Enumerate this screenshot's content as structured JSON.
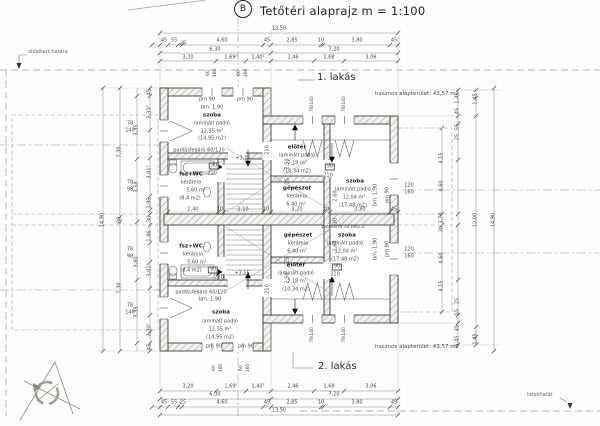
{
  "title": {
    "section_marker": "B",
    "text": "Tetőtéri alaprajz  m = 1:100"
  },
  "units": {
    "flat1": {
      "label": "1. lakás",
      "area": "hasznos alapterület: 43,57 m2"
    },
    "flat2": {
      "label": "2. lakás",
      "area": "hasznos alapterület: 43,57 m2"
    }
  },
  "boundaries": {
    "side_garden": "oldalkert határa",
    "plot": "telekhatár"
  },
  "plan_labels": {
    "dimensions": [
      {
        "t": "13,50",
        "x": 279,
        "y": 29
      },
      {
        "t": "45",
        "x": 164,
        "y": 41
      },
      {
        "t": "55",
        "x": 174,
        "y": 41
      },
      {
        "t": "25",
        "x": 183,
        "y": 44
      },
      {
        "t": "4,60",
        "x": 222,
        "y": 41
      },
      {
        "t": "45",
        "x": 267,
        "y": 41
      },
      {
        "t": "2,85",
        "x": 292,
        "y": 41
      },
      {
        "t": "10",
        "x": 321,
        "y": 41
      },
      {
        "t": "3,80",
        "x": 357,
        "y": 41
      },
      {
        "t": "45",
        "x": 394,
        "y": 41
      },
      {
        "t": "6,30",
        "x": 215,
        "y": 50
      },
      {
        "t": "7,20",
        "x": 334,
        "y": 50
      },
      {
        "t": "3,20",
        "x": 188,
        "y": 58
      },
      {
        "t": "1,69⁵",
        "x": 231,
        "y": 58
      },
      {
        "t": "1,40²",
        "x": 258,
        "y": 58
      },
      {
        "t": "2,46",
        "x": 293,
        "y": 58
      },
      {
        "t": "1,68",
        "x": 329,
        "y": 58
      },
      {
        "t": "3,06",
        "x": 371,
        "y": 58
      },
      {
        "t": "3,20",
        "x": 188,
        "y": 387
      },
      {
        "t": "1,69⁵",
        "x": 231,
        "y": 387
      },
      {
        "t": "1,40²",
        "x": 258,
        "y": 387
      },
      {
        "t": "2,46",
        "x": 293,
        "y": 387
      },
      {
        "t": "1,68",
        "x": 329,
        "y": 387
      },
      {
        "t": "3,06",
        "x": 371,
        "y": 387
      },
      {
        "t": "6,30",
        "x": 215,
        "y": 395
      },
      {
        "t": "7,20",
        "x": 334,
        "y": 395
      },
      {
        "t": "45",
        "x": 164,
        "y": 403
      },
      {
        "t": "55",
        "x": 174,
        "y": 403
      },
      {
        "t": "25",
        "x": 183,
        "y": 403
      },
      {
        "t": "4,60",
        "x": 222,
        "y": 403
      },
      {
        "t": "45",
        "x": 267,
        "y": 403
      },
      {
        "t": "2,85",
        "x": 292,
        "y": 403
      },
      {
        "t": "10",
        "x": 321,
        "y": 403
      },
      {
        "t": "3,80",
        "x": 357,
        "y": 403
      },
      {
        "t": "45",
        "x": 394,
        "y": 403
      },
      {
        "t": "13,50",
        "x": 279,
        "y": 411
      },
      {
        "t": "14,90",
        "x": 103,
        "y": 220,
        "r": 1
      },
      {
        "t": "7,30",
        "x": 120,
        "y": 152,
        "r": 1
      },
      {
        "t": "30",
        "x": 120,
        "y": 220,
        "r": 1
      },
      {
        "t": "7,30",
        "x": 120,
        "y": 288,
        "r": 1
      },
      {
        "t": "3,35",
        "x": 137,
        "y": 130,
        "r": 1
      },
      {
        "t": "3,58",
        "x": 137,
        "y": 187,
        "r": 1
      },
      {
        "t": "3,80",
        "x": 137,
        "y": 262,
        "r": 1
      },
      {
        "t": "3,35",
        "x": 137,
        "y": 312,
        "r": 1
      },
      {
        "t": "45",
        "x": 150,
        "y": 92,
        "r": 1
      },
      {
        "t": "2,33⁵",
        "x": 150,
        "y": 112,
        "r": 1
      },
      {
        "t": "3,01⁵",
        "x": 150,
        "y": 172,
        "r": 1
      },
      {
        "t": "1,95",
        "x": 150,
        "y": 203,
        "r": 1
      },
      {
        "t": "30",
        "x": 150,
        "y": 219,
        "r": 1
      },
      {
        "t": "1,86",
        "x": 150,
        "y": 236,
        "r": 1
      },
      {
        "t": "3,01⁵",
        "x": 150,
        "y": 270,
        "r": 1
      },
      {
        "t": "2,30⁵",
        "x": 150,
        "y": 330,
        "r": 1
      },
      {
        "t": "45",
        "x": 150,
        "y": 347,
        "r": 1
      },
      {
        "t": "4,15",
        "x": 442,
        "y": 158,
        "r": 1
      },
      {
        "t": "4,60",
        "x": 442,
        "y": 186,
        "r": 1
      },
      {
        "t": "3,70",
        "x": 442,
        "y": 218,
        "r": 1
      },
      {
        "t": "30",
        "x": 442,
        "y": 229,
        "r": 1
      },
      {
        "t": "4,60",
        "x": 442,
        "y": 258,
        "r": 1
      },
      {
        "t": "4,15",
        "x": 442,
        "y": 286,
        "r": 1
      },
      {
        "t": "1,45",
        "x": 458,
        "y": 98,
        "r": 1
      },
      {
        "t": "45",
        "x": 458,
        "y": 111,
        "r": 1
      },
      {
        "t": "55",
        "x": 458,
        "y": 127,
        "r": 1
      },
      {
        "t": "25",
        "x": 458,
        "y": 137,
        "r": 1
      },
      {
        "t": "25",
        "x": 458,
        "y": 301,
        "r": 1
      },
      {
        "t": "55",
        "x": 458,
        "y": 312,
        "r": 1
      },
      {
        "t": "45",
        "x": 458,
        "y": 328,
        "r": 1
      },
      {
        "t": "1,45",
        "x": 458,
        "y": 341,
        "r": 1
      },
      {
        "t": "1,45",
        "x": 476,
        "y": 99,
        "r": 1
      },
      {
        "t": "12,00",
        "x": 476,
        "y": 220,
        "r": 1
      },
      {
        "t": "1,45",
        "x": 476,
        "y": 339,
        "r": 1
      },
      {
        "t": "14,90",
        "x": 494,
        "y": 220,
        "r": 1
      },
      {
        "t": "2,40",
        "x": 193,
        "y": 210
      },
      {
        "t": "10",
        "x": 220,
        "y": 210
      },
      {
        "t": "2,10",
        "x": 243,
        "y": 210
      },
      {
        "t": "10",
        "x": 266,
        "y": 210
      },
      {
        "t": "3,20",
        "x": 297,
        "y": 210
      },
      {
        "t": "10",
        "x": 326,
        "y": 210
      },
      {
        "t": "3,80",
        "x": 360,
        "y": 210
      },
      {
        "t": "45",
        "x": 394,
        "y": 210
      },
      {
        "t": "2,50",
        "x": 288,
        "y": 164,
        "r": 1
      },
      {
        "t": "25",
        "x": 288,
        "y": 181,
        "r": 1
      },
      {
        "t": "2,60",
        "x": 336,
        "y": 196,
        "r": 1
      },
      {
        "t": "30",
        "x": 336,
        "y": 221,
        "r": 1
      },
      {
        "t": "2,60",
        "x": 336,
        "y": 246,
        "r": 1
      },
      {
        "t": "25",
        "x": 288,
        "y": 260,
        "r": 1
      },
      {
        "t": "2,50",
        "x": 288,
        "y": 278,
        "r": 1
      },
      {
        "t": "60",
        "x": 209,
        "y": 73,
        "r": 1,
        "sm": 1
      },
      {
        "t": "160",
        "x": 216,
        "y": 73,
        "r": 1,
        "sm": 1
      },
      {
        "t": "60",
        "x": 240,
        "y": 73,
        "r": 1,
        "sm": 1
      },
      {
        "t": "160",
        "x": 247,
        "y": 73,
        "r": 1,
        "sm": 1
      },
      {
        "t": "60",
        "x": 215,
        "y": 368,
        "r": 1,
        "sm": 1
      },
      {
        "t": "160",
        "x": 222,
        "y": 368,
        "r": 1,
        "sm": 1
      },
      {
        "t": "60",
        "x": 242,
        "y": 368,
        "r": 1,
        "sm": 1
      },
      {
        "t": "160",
        "x": 249,
        "y": 368,
        "r": 1,
        "sm": 1
      }
    ],
    "rooms": [
      {
        "t": "pm 90",
        "x": 207,
        "y": 100
      },
      {
        "t": "pm 90",
        "x": 245,
        "y": 100
      },
      {
        "t": "bm. 1,90",
        "x": 212,
        "y": 108
      },
      {
        "t": "szoba",
        "x": 212,
        "y": 116,
        "b": 1
      },
      {
        "t": "laminált padló",
        "x": 212,
        "y": 124
      },
      {
        "t": "12,35 m²",
        "x": 212,
        "y": 132
      },
      {
        "t": "(14,95 m2)",
        "x": 212,
        "y": 139
      },
      {
        "t": "padlásfeljáró 60/120",
        "x": 199,
        "y": 151
      },
      {
        "t": "fsz+WC",
        "x": 191,
        "y": 175,
        "b": 1
      },
      {
        "t": "kerámia",
        "x": 191,
        "y": 183
      },
      {
        "t": "5,60 m²",
        "x": 196,
        "y": 191
      },
      {
        "t": "(8,4 m2)",
        "x": 190,
        "y": 199
      },
      {
        "t": "előtér",
        "x": 297,
        "y": 148,
        "b": 1
      },
      {
        "t": "laminált padló",
        "x": 297,
        "y": 156
      },
      {
        "t": "7,18 m²",
        "x": 297,
        "y": 164
      },
      {
        "t": "(10,34 m2)",
        "x": 297,
        "y": 172
      },
      {
        "t": "gépészet",
        "x": 297,
        "y": 189,
        "b": 1
      },
      {
        "t": "kerámia",
        "x": 297,
        "y": 197
      },
      {
        "t": "6,40 m²",
        "x": 296,
        "y": 205
      },
      {
        "t": "szoba",
        "x": 355,
        "y": 182,
        "b": 1
      },
      {
        "t": "laminált padló",
        "x": 353,
        "y": 190
      },
      {
        "t": "12,04 m²",
        "x": 354,
        "y": 198
      },
      {
        "t": "(17,48 m2)",
        "x": 353,
        "y": 206
      },
      {
        "t": "bm. 1,90",
        "x": 376,
        "y": 195,
        "r": 1
      },
      {
        "t": "pm 90",
        "x": 388,
        "y": 195,
        "r": 1
      },
      {
        "t": "szoba",
        "x": 347,
        "y": 236,
        "b": 1
      },
      {
        "t": "laminált padló",
        "x": 345,
        "y": 244
      },
      {
        "t": "12,04 m²",
        "x": 346,
        "y": 252
      },
      {
        "t": "(17,48 m2)",
        "x": 345,
        "y": 260
      },
      {
        "t": "bm. 1,90",
        "x": 376,
        "y": 249,
        "r": 1
      },
      {
        "t": "pm 90",
        "x": 388,
        "y": 249,
        "r": 1
      },
      {
        "t": "gépészet",
        "x": 298,
        "y": 236,
        "b": 1
      },
      {
        "t": "kerámia",
        "x": 298,
        "y": 244
      },
      {
        "t": "6,40 m²",
        "x": 297,
        "y": 252
      },
      {
        "t": "előtér",
        "x": 296,
        "y": 266,
        "b": 1
      },
      {
        "t": "laminált padló",
        "x": 296,
        "y": 274
      },
      {
        "t": "7,18 m²",
        "x": 297,
        "y": 282
      },
      {
        "t": "(10,34 m2)",
        "x": 296,
        "y": 290
      },
      {
        "t": "fsz+WC",
        "x": 191,
        "y": 247,
        "b": 1
      },
      {
        "t": "kerámia",
        "x": 193,
        "y": 255
      },
      {
        "t": "5,60 m²",
        "x": 197,
        "y": 263
      },
      {
        "t": "(8,4 m2)",
        "x": 191,
        "y": 271
      },
      {
        "t": "padlásfeljáró 60/120",
        "x": 201,
        "y": 293
      },
      {
        "t": "bm. 1,90",
        "x": 210,
        "y": 300
      },
      {
        "t": "szoba",
        "x": 221,
        "y": 313,
        "b": 1
      },
      {
        "t": "laminált padló",
        "x": 220,
        "y": 322
      },
      {
        "t": "12,35 m²",
        "x": 220,
        "y": 330
      },
      {
        "t": "(14,95 m2)",
        "x": 220,
        "y": 338
      },
      {
        "t": "pm 90",
        "x": 214,
        "y": 347
      },
      {
        "t": "pm 90",
        "x": 246,
        "y": 347
      }
    ],
    "annotations": [
      {
        "t": "78",
        "x": 130,
        "y": 124
      },
      {
        "t": "140",
        "x": 130,
        "y": 131
      },
      {
        "t": "78",
        "x": 130,
        "y": 183
      },
      {
        "t": "98",
        "x": 130,
        "y": 190
      },
      {
        "t": "78",
        "x": 130,
        "y": 250
      },
      {
        "t": "98",
        "x": 130,
        "y": 257
      },
      {
        "t": "78",
        "x": 130,
        "y": 306
      },
      {
        "t": "140",
        "x": 130,
        "y": 313
      },
      {
        "t": "120",
        "x": 409,
        "y": 186
      },
      {
        "t": "160",
        "x": 409,
        "y": 193
      },
      {
        "t": "120",
        "x": 409,
        "y": 250
      },
      {
        "t": "160",
        "x": 409,
        "y": 257
      },
      {
        "t": "78/140",
        "x": 313,
        "y": 104,
        "r": 1,
        "sm": 1
      },
      {
        "t": "78/140",
        "x": 345,
        "y": 104,
        "r": 1,
        "sm": 1
      },
      {
        "t": "78/140",
        "x": 313,
        "y": 335,
        "r": 1,
        "sm": 1
      },
      {
        "t": "78/140",
        "x": 345,
        "y": 335,
        "r": 1,
        "sm": 1
      },
      {
        "t": "90",
        "x": 214,
        "y": 166,
        "box": 1
      },
      {
        "t": "210",
        "x": 212,
        "y": 174
      },
      {
        "t": "90",
        "x": 213,
        "y": 270,
        "box": 1
      },
      {
        "t": "210",
        "x": 219,
        "y": 278
      },
      {
        "t": "90",
        "x": 330,
        "y": 167,
        "box": 1
      },
      {
        "t": "210",
        "x": 328,
        "y": 176
      },
      {
        "t": "90",
        "x": 337,
        "y": 267,
        "box": 1
      },
      {
        "t": "210",
        "x": 335,
        "y": 275
      },
      {
        "t": "210",
        "x": 268,
        "y": 150,
        "r": 1
      },
      {
        "t": "210",
        "x": 268,
        "y": 289,
        "r": 1
      },
      {
        "t": "+3,15",
        "x": 243,
        "y": 159
      },
      {
        "t": "+3,15",
        "x": 242,
        "y": 274
      },
      {
        "t": "protherm 30 AKU Z",
        "x": 343,
        "y": 228,
        "sm": 1
      }
    ]
  }
}
